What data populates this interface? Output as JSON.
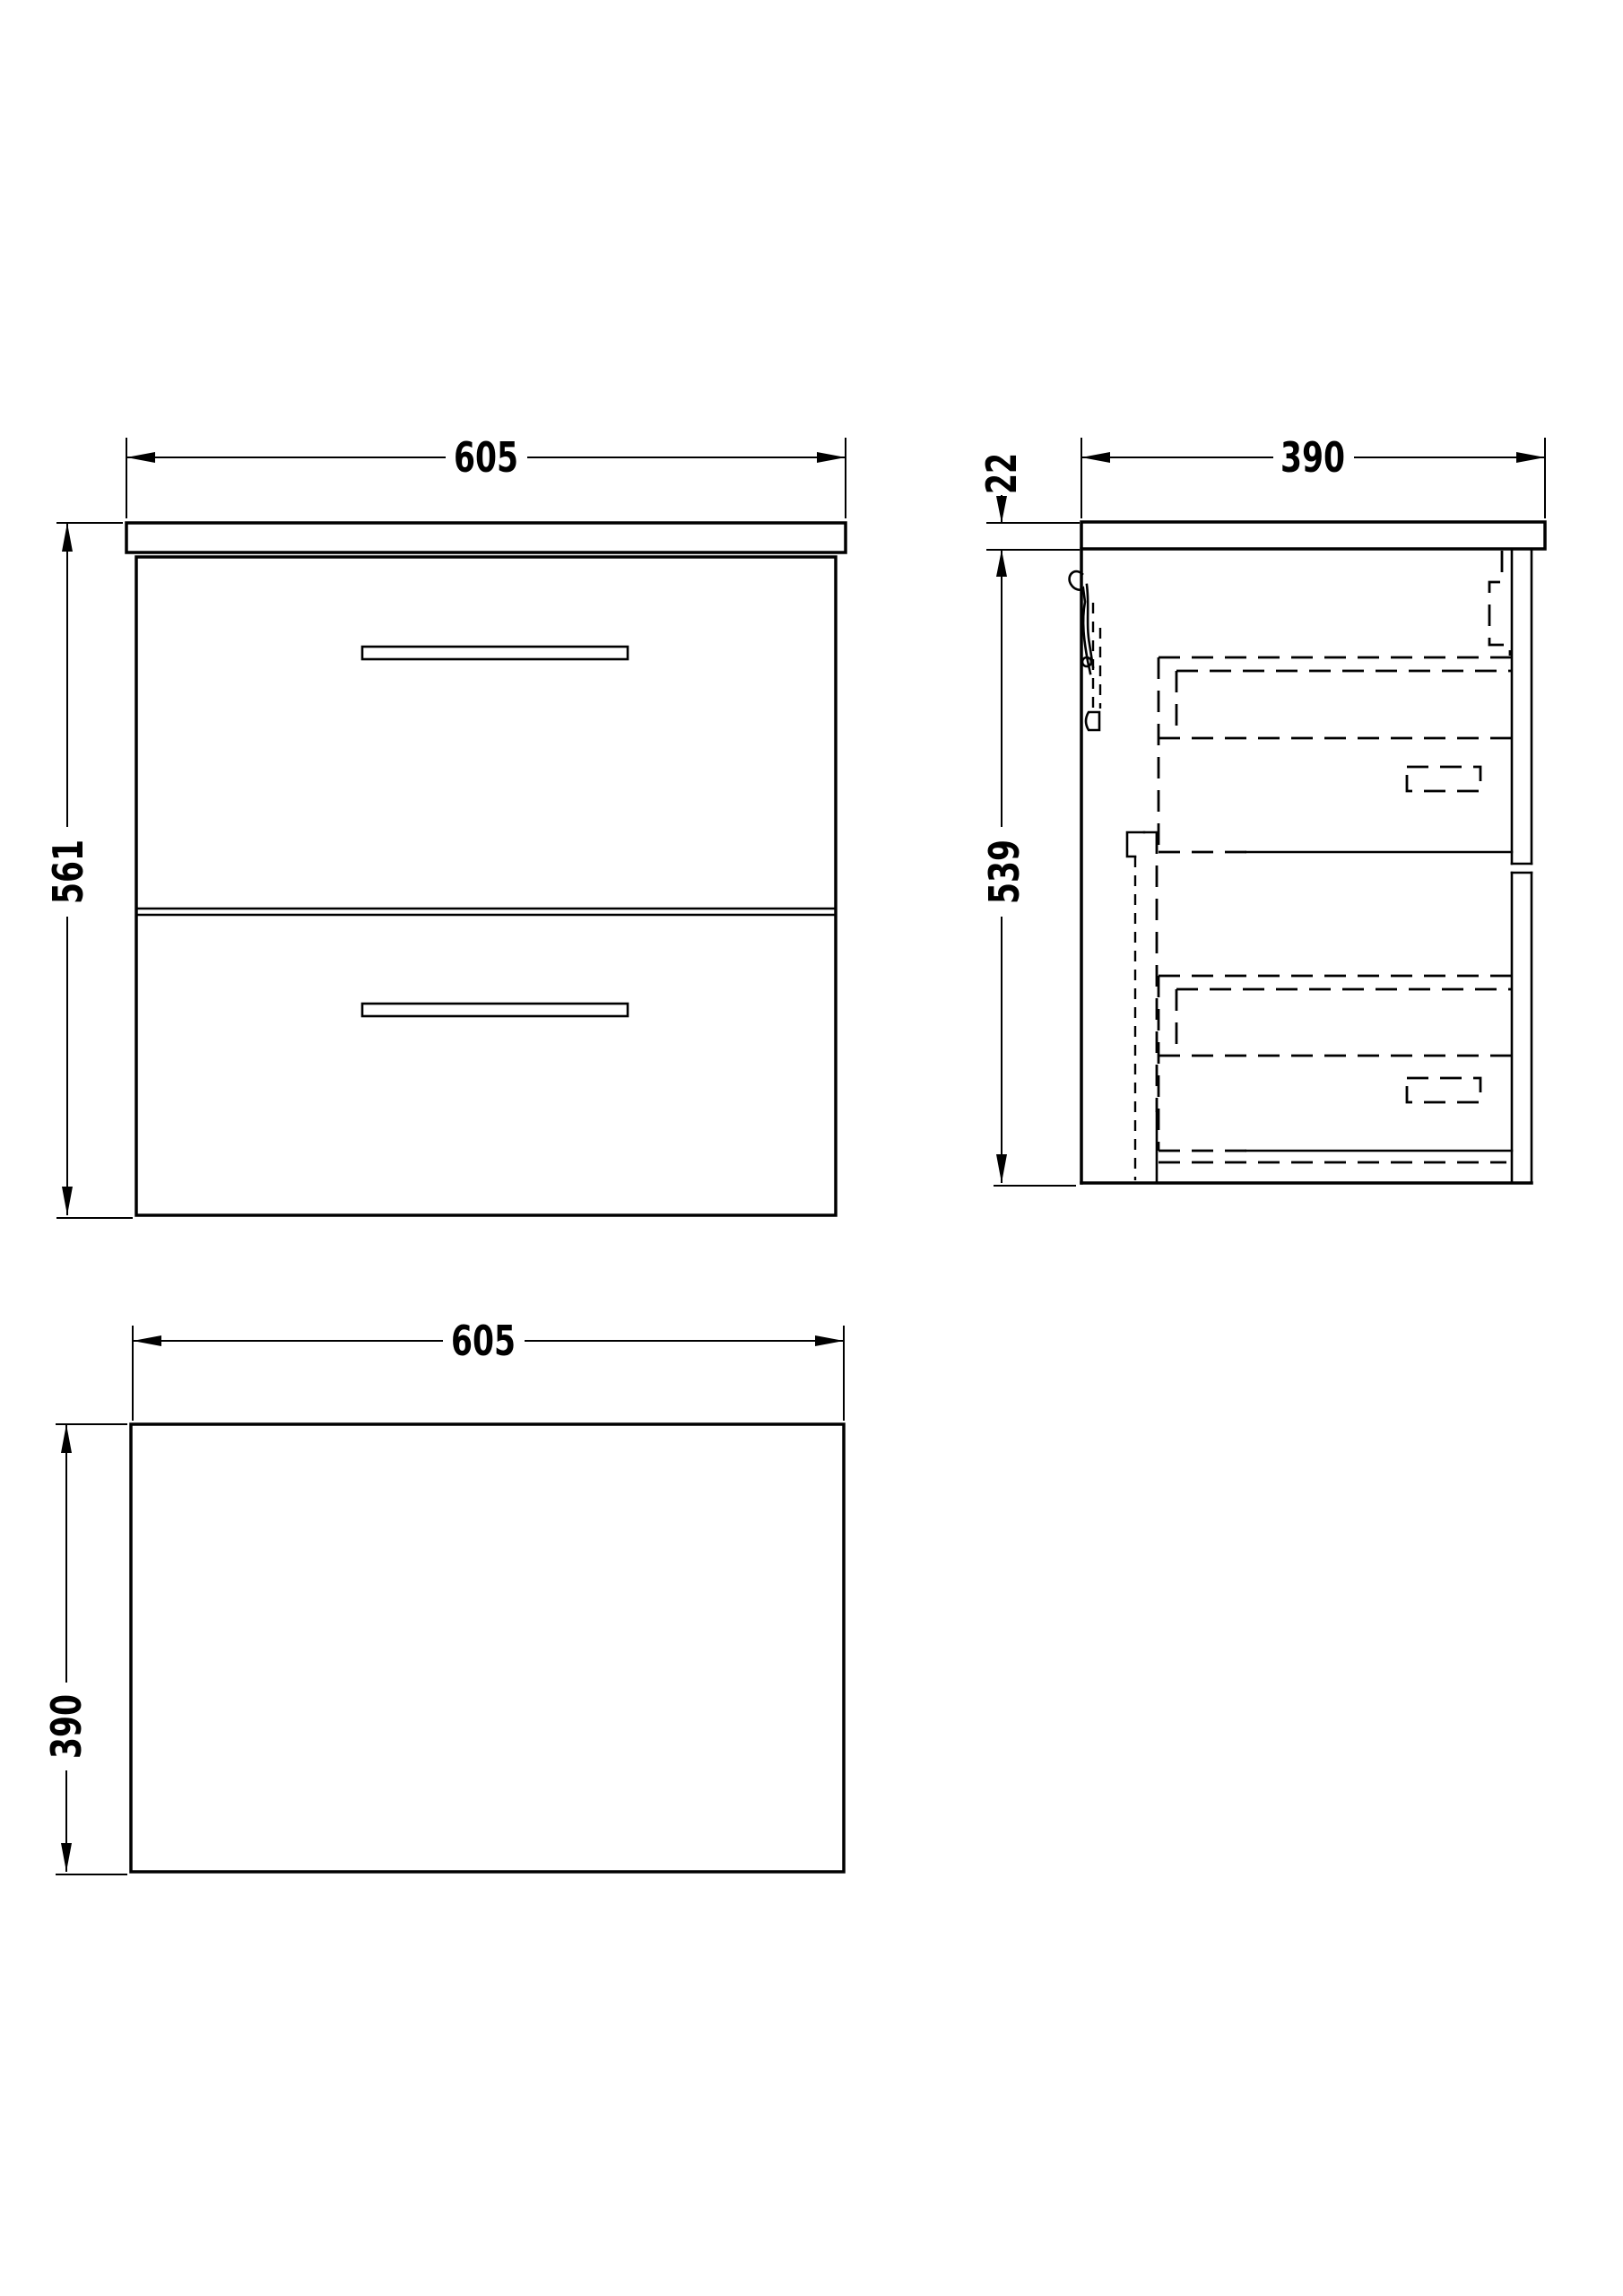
{
  "drawing": {
    "background_color": "#ffffff",
    "line_color": "#000000",
    "views": {
      "front": {
        "width_dim": "605",
        "height_dim": "561"
      },
      "side": {
        "depth_dim": "390",
        "countertop_thickness_dim": "22",
        "cabinet_height_dim": "539"
      },
      "plan": {
        "width_dim": "605",
        "depth_dim": "390"
      }
    }
  }
}
